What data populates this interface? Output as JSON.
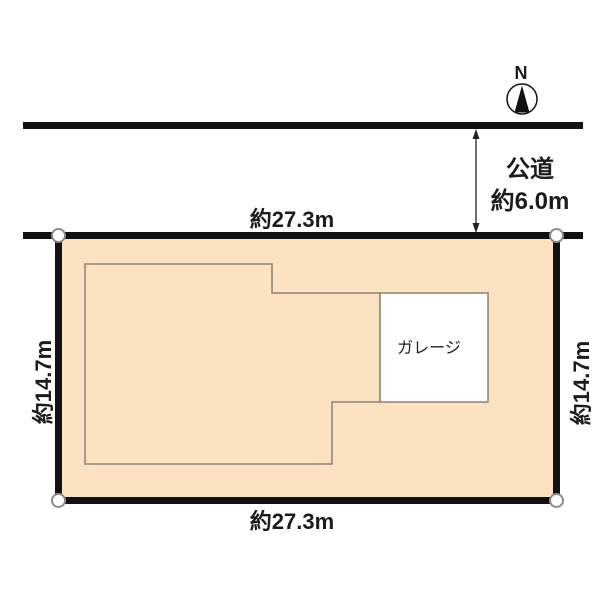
{
  "compass": {
    "north_label": "N"
  },
  "road": {
    "name": "公道",
    "width_label": "約6.0m"
  },
  "lot": {
    "top_width_label": "約27.3m",
    "bottom_width_label": "約27.3m",
    "left_depth_label": "約14.7m",
    "right_depth_label": "約14.7m",
    "garage_label": "ガレージ"
  },
  "colors": {
    "lot_fill": "#FBE3C1",
    "border": "#111111",
    "building_outline": "#8B8374",
    "corner_marker_stroke": "#8C8C8C",
    "garage_fill": "#FFFFFF",
    "text": "#1C1C1C"
  }
}
